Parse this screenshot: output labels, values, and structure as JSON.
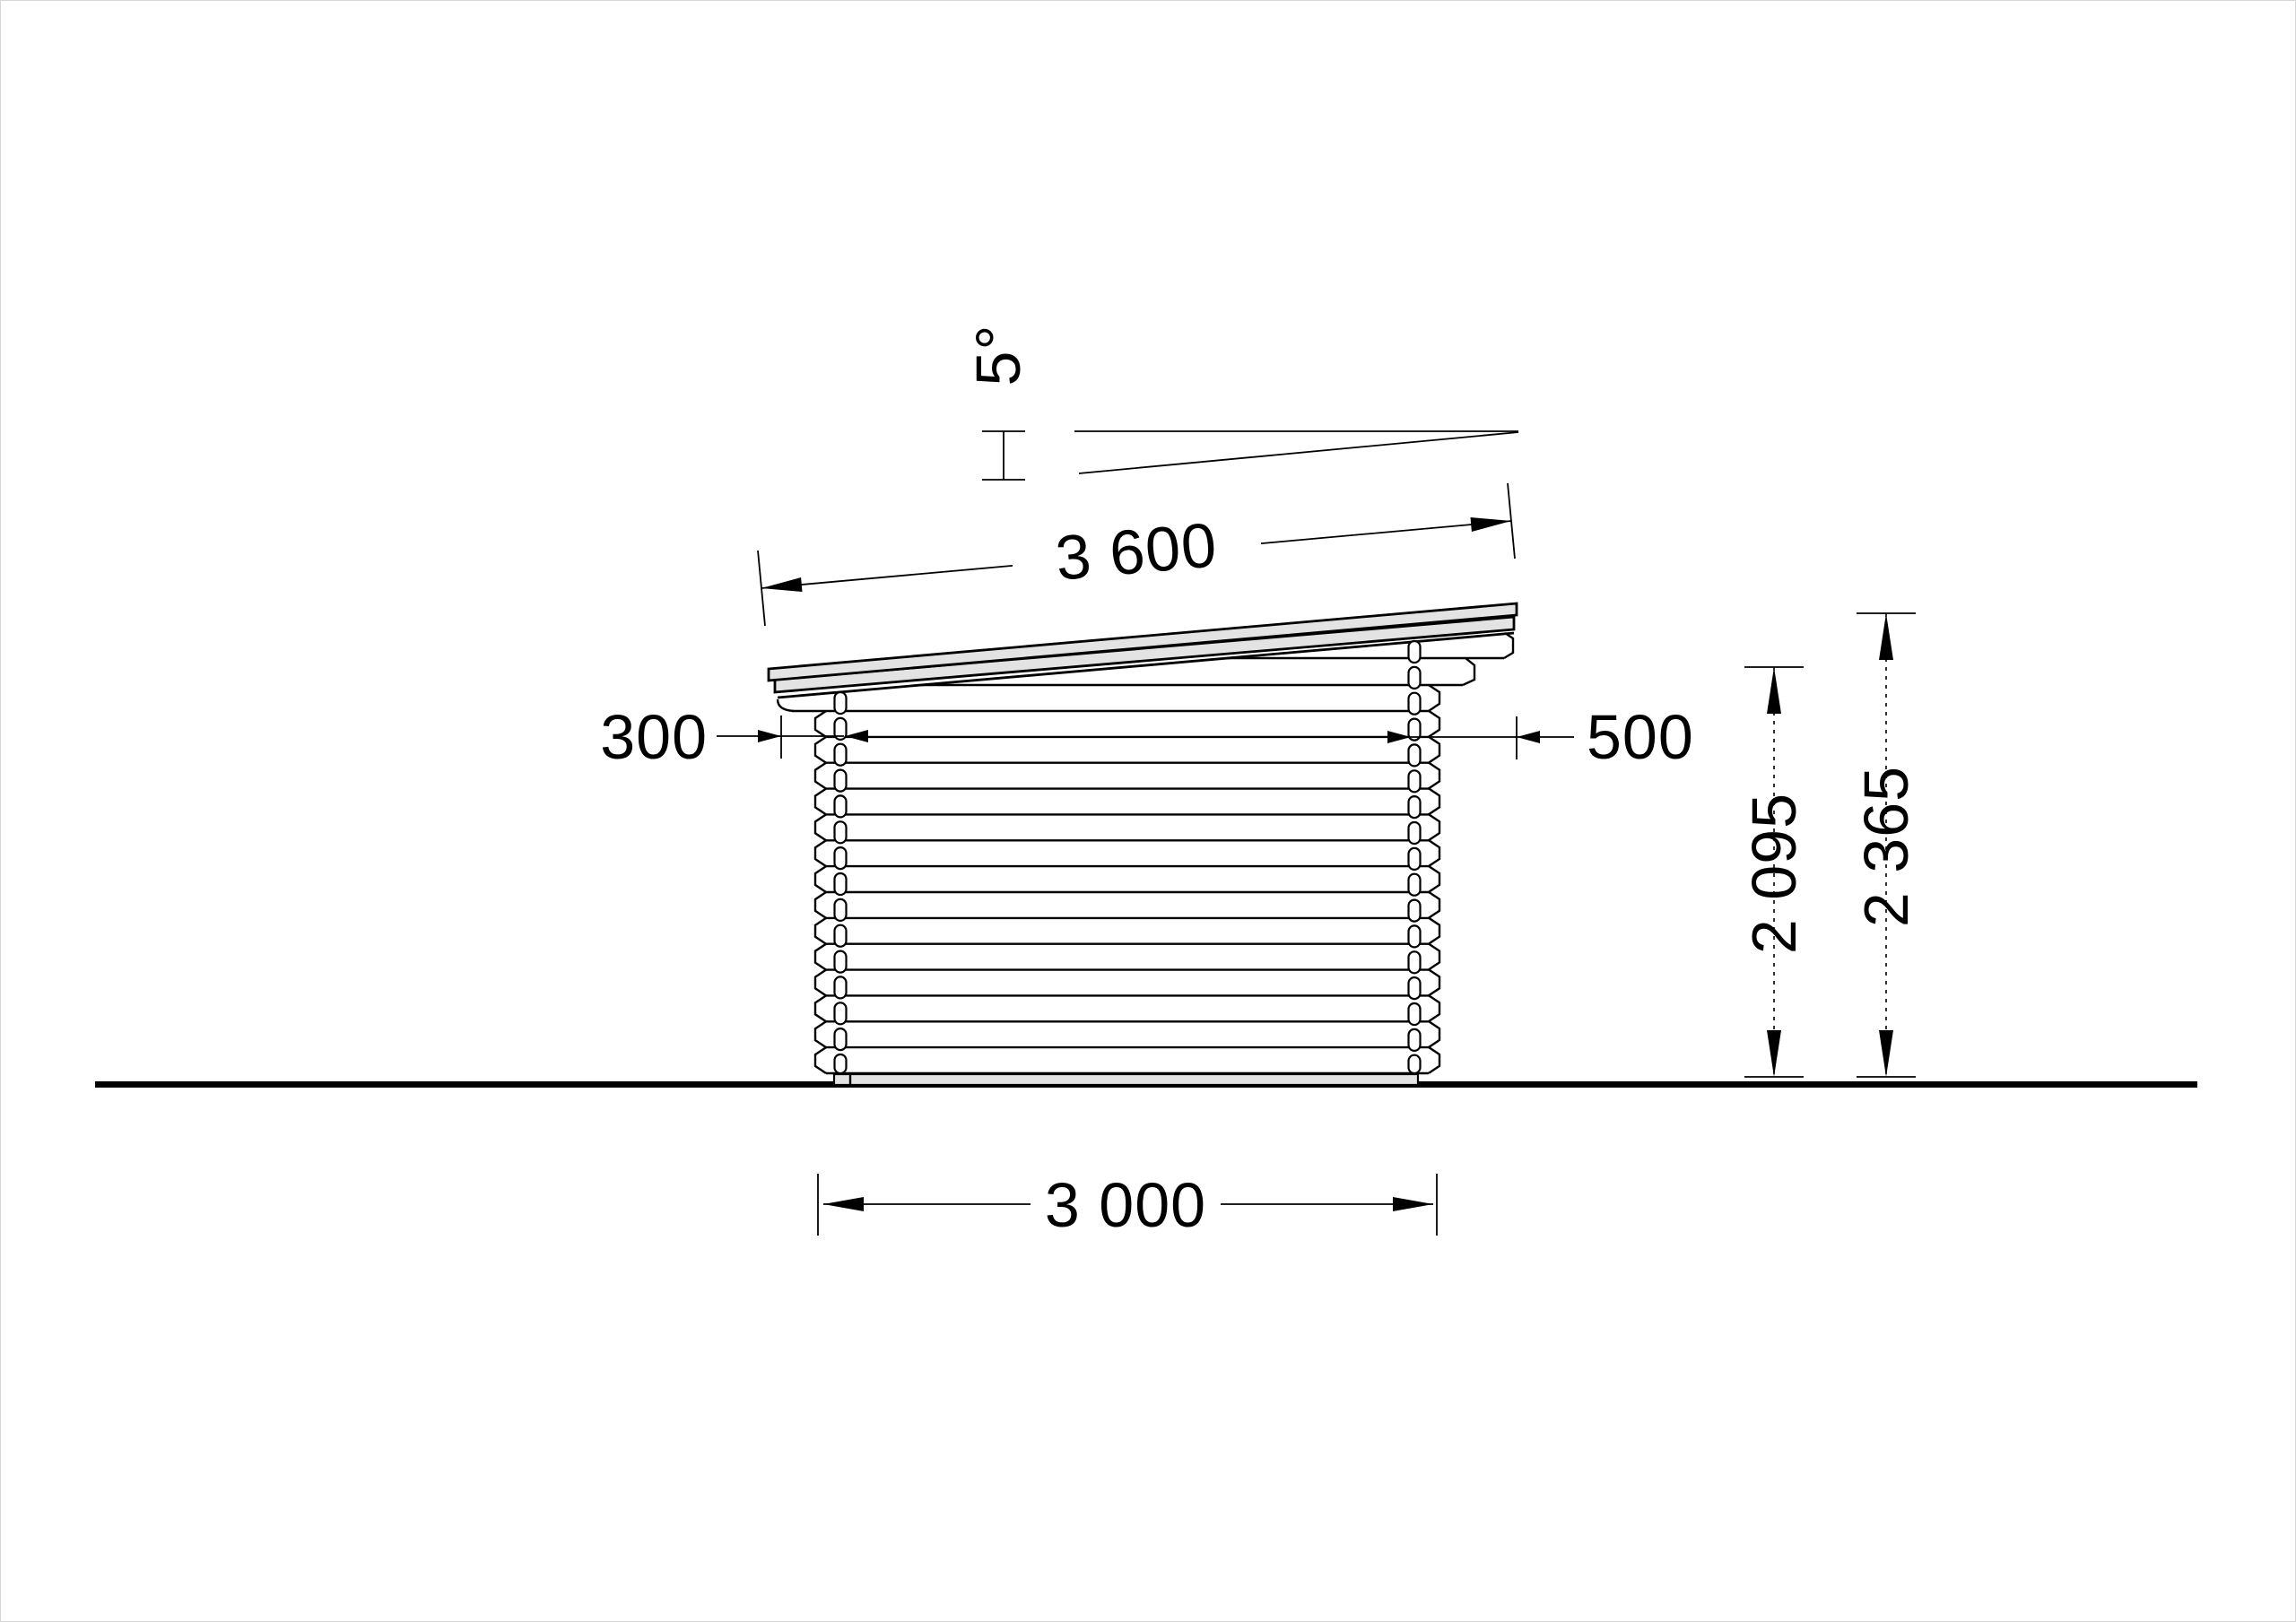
{
  "drawing": {
    "type": "side-elevation-log-cabin",
    "roof_angle_label": "5°",
    "roof_length_label": "3 600",
    "left_overhang_label": "300",
    "right_overhang_label": "500",
    "wall_height_label": "2 095",
    "total_height_label": "2 365",
    "base_width_label": "3 000"
  },
  "style": {
    "roof_fill": "#e3e3e3",
    "line_color": "#000000",
    "background": "#ffffff"
  }
}
